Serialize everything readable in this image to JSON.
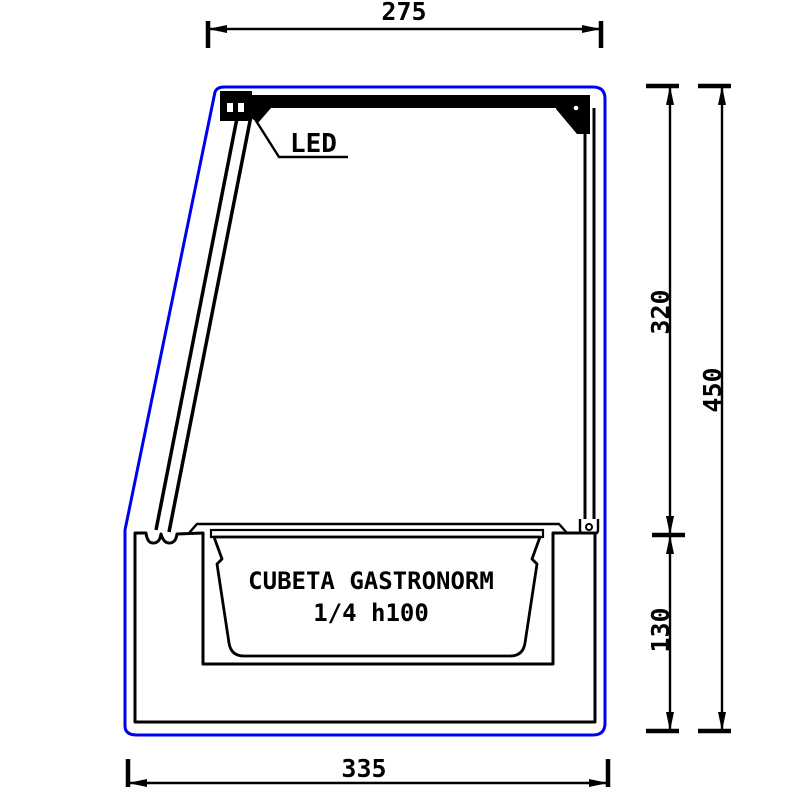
{
  "drawing": {
    "type": "technical-cross-section",
    "subject": "refrigerated display case side section with gastronorm tub",
    "colors": {
      "outer_profile": "#0000f0",
      "line": "#000000",
      "background": "#ffffff"
    },
    "labels": {
      "led": "LED",
      "tub_line1": "CUBETA GASTRONORM",
      "tub_line2": "1/4 h100"
    },
    "dimensions": {
      "top_width": "275",
      "glass_height": "320",
      "total_height": "450",
      "base_height": "130",
      "base_width": "335"
    }
  }
}
